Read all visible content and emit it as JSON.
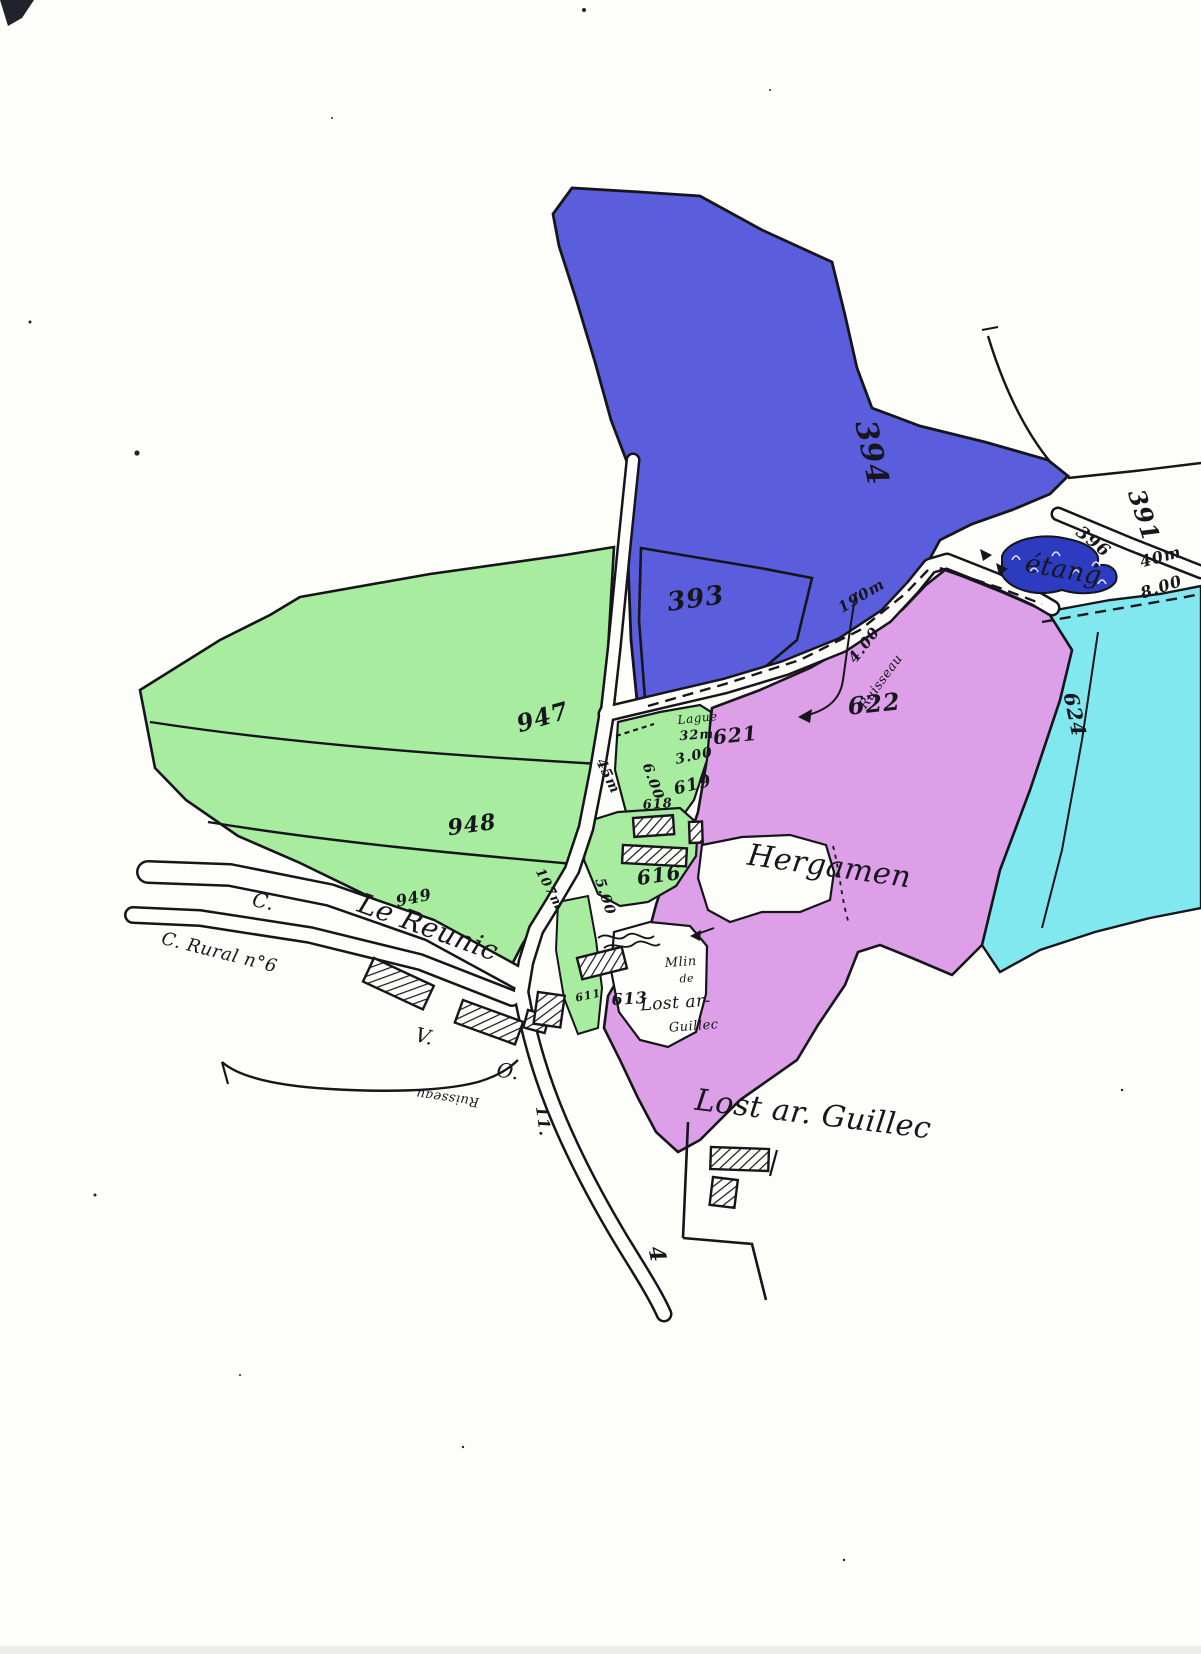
{
  "colors": {
    "paper": "#fdfdfa",
    "ink": "#15151a",
    "parcel_blue": "#5a5edd",
    "pond_blue": "#2d3bc0",
    "parcel_green": "#a8ec9f",
    "parcel_pink": "#dc9fe8",
    "parcel_cyan": "#82e8ef"
  },
  "map": {
    "kind": "hand-drawn cadastral parcel map",
    "place_names": [
      "Hergamen",
      "Le Reunic",
      "Lost ar. Guillec",
      "étang",
      "C. Rural n°6"
    ],
    "labels": [
      {
        "name": "p394",
        "text": "394",
        "x": 862,
        "y": 455,
        "rot": 78,
        "size": 30,
        "kind": "num"
      },
      {
        "name": "p393",
        "text": "393",
        "x": 697,
        "y": 607,
        "rot": -8,
        "size": 26,
        "kind": "num"
      },
      {
        "name": "p391",
        "text": "391",
        "x": 1136,
        "y": 518,
        "rot": 72,
        "size": 24,
        "kind": "num"
      },
      {
        "name": "p396",
        "text": "396",
        "x": 1090,
        "y": 546,
        "rot": 38,
        "size": 17,
        "kind": "num"
      },
      {
        "name": "etang",
        "text": "étang",
        "x": 1062,
        "y": 578,
        "rot": 10,
        "size": 26,
        "kind": "script"
      },
      {
        "name": "dist-40m",
        "text": "40m",
        "x": 1162,
        "y": 562,
        "rot": -15,
        "size": 16,
        "kind": "num"
      },
      {
        "name": "path-8-00",
        "text": "8.00",
        "x": 1163,
        "y": 592,
        "rot": -18,
        "size": 16,
        "kind": "num"
      },
      {
        "name": "p624",
        "text": "624",
        "x": 1068,
        "y": 716,
        "rot": 78,
        "size": 20,
        "kind": "num"
      },
      {
        "name": "p622",
        "text": "622",
        "x": 875,
        "y": 712,
        "rot": -6,
        "size": 24,
        "kind": "num"
      },
      {
        "name": "p621",
        "text": "621",
        "x": 736,
        "y": 742,
        "rot": -6,
        "size": 20,
        "kind": "num"
      },
      {
        "name": "p619",
        "text": "619",
        "x": 694,
        "y": 790,
        "rot": -14,
        "size": 17,
        "kind": "num"
      },
      {
        "name": "p618",
        "text": "618",
        "x": 658,
        "y": 808,
        "rot": -4,
        "size": 13,
        "kind": "num"
      },
      {
        "name": "p616",
        "text": "616",
        "x": 660,
        "y": 882,
        "rot": -8,
        "size": 20,
        "kind": "num"
      },
      {
        "name": "p613",
        "text": "613",
        "x": 630,
        "y": 1004,
        "rot": -4,
        "size": 16,
        "kind": "num"
      },
      {
        "name": "p611",
        "text": "611",
        "x": 589,
        "y": 999,
        "rot": -12,
        "size": 11,
        "kind": "num"
      },
      {
        "name": "p947",
        "text": "947",
        "x": 545,
        "y": 725,
        "rot": -16,
        "size": 24,
        "kind": "num"
      },
      {
        "name": "p948",
        "text": "948",
        "x": 473,
        "y": 832,
        "rot": -8,
        "size": 22,
        "kind": "num"
      },
      {
        "name": "p949",
        "text": "949",
        "x": 415,
        "y": 903,
        "rot": -12,
        "size": 16,
        "kind": "num"
      },
      {
        "name": "dist-45m",
        "text": "45m",
        "x": 604,
        "y": 778,
        "rot": 64,
        "size": 14,
        "kind": "num"
      },
      {
        "name": "w-6-00",
        "text": "6.00",
        "x": 649,
        "y": 783,
        "rot": 70,
        "size": 14,
        "kind": "num"
      },
      {
        "name": "w-3-00",
        "text": "3.00",
        "x": 695,
        "y": 760,
        "rot": -12,
        "size": 14,
        "kind": "num"
      },
      {
        "name": "dist-32m",
        "text": "32m",
        "x": 697,
        "y": 739,
        "rot": -4,
        "size": 13,
        "kind": "num"
      },
      {
        "name": "lague",
        "text": "Lague",
        "x": 698,
        "y": 722,
        "rot": -6,
        "size": 12,
        "kind": "script"
      },
      {
        "name": "w-5-00",
        "text": "5.00",
        "x": 601,
        "y": 898,
        "rot": 72,
        "size": 14,
        "kind": "num"
      },
      {
        "name": "dist-107m",
        "text": "107m",
        "x": 546,
        "y": 891,
        "rot": 62,
        "size": 13,
        "kind": "num"
      },
      {
        "name": "dist-190m",
        "text": "190m",
        "x": 864,
        "y": 600,
        "rot": -31,
        "size": 15,
        "kind": "num"
      },
      {
        "name": "w-4-00",
        "text": "4.00",
        "x": 868,
        "y": 648,
        "rot": -52,
        "size": 15,
        "kind": "num"
      },
      {
        "name": "ruisseau-upper",
        "text": "Ruisseau",
        "x": 884,
        "y": 684,
        "rot": -54,
        "size": 13,
        "kind": "script"
      },
      {
        "name": "hergamen",
        "text": "Hergamen",
        "x": 828,
        "y": 876,
        "rot": 8,
        "size": 30,
        "kind": "script"
      },
      {
        "name": "le-reunic",
        "text": "Le Reunic",
        "x": 425,
        "y": 936,
        "rot": 20,
        "size": 28,
        "kind": "script"
      },
      {
        "name": "c-abbrev",
        "text": "C.",
        "x": 262,
        "y": 908,
        "rot": 12,
        "size": 20,
        "kind": "script"
      },
      {
        "name": "c-rural",
        "text": "C. Rural n°6",
        "x": 218,
        "y": 958,
        "rot": 14,
        "size": 18,
        "kind": "script"
      },
      {
        "name": "mlin",
        "text": "Mlin",
        "x": 681,
        "y": 966,
        "rot": -4,
        "size": 13,
        "kind": "script"
      },
      {
        "name": "mlin-de",
        "text": "de",
        "x": 687,
        "y": 982,
        "rot": -4,
        "size": 11,
        "kind": "script"
      },
      {
        "name": "lost-small",
        "text": "Lost ar-",
        "x": 676,
        "y": 1008,
        "rot": -4,
        "size": 17,
        "kind": "script"
      },
      {
        "name": "guillec-small",
        "text": "Guillec",
        "x": 694,
        "y": 1030,
        "rot": -4,
        "size": 13,
        "kind": "script"
      },
      {
        "name": "lost-big",
        "text": "Lost ar. Guillec",
        "x": 812,
        "y": 1124,
        "rot": 7,
        "size": 30,
        "kind": "script"
      },
      {
        "name": "v-abbrev",
        "text": "V.",
        "x": 423,
        "y": 1043,
        "rot": 14,
        "size": 20,
        "kind": "script"
      },
      {
        "name": "o-abbrev",
        "text": "O.",
        "x": 507,
        "y": 1078,
        "rot": 8,
        "size": 20,
        "kind": "script"
      },
      {
        "name": "ruisseau-lower",
        "text": "Ruisseau",
        "x": 448,
        "y": 1094,
        "rot": 188,
        "size": 13,
        "kind": "script"
      },
      {
        "name": "n11",
        "text": "11.",
        "x": 538,
        "y": 1122,
        "rot": 82,
        "size": 16,
        "kind": "num"
      },
      {
        "name": "n4",
        "text": "4",
        "x": 650,
        "y": 1256,
        "rot": 78,
        "size": 22,
        "kind": "num"
      }
    ]
  }
}
